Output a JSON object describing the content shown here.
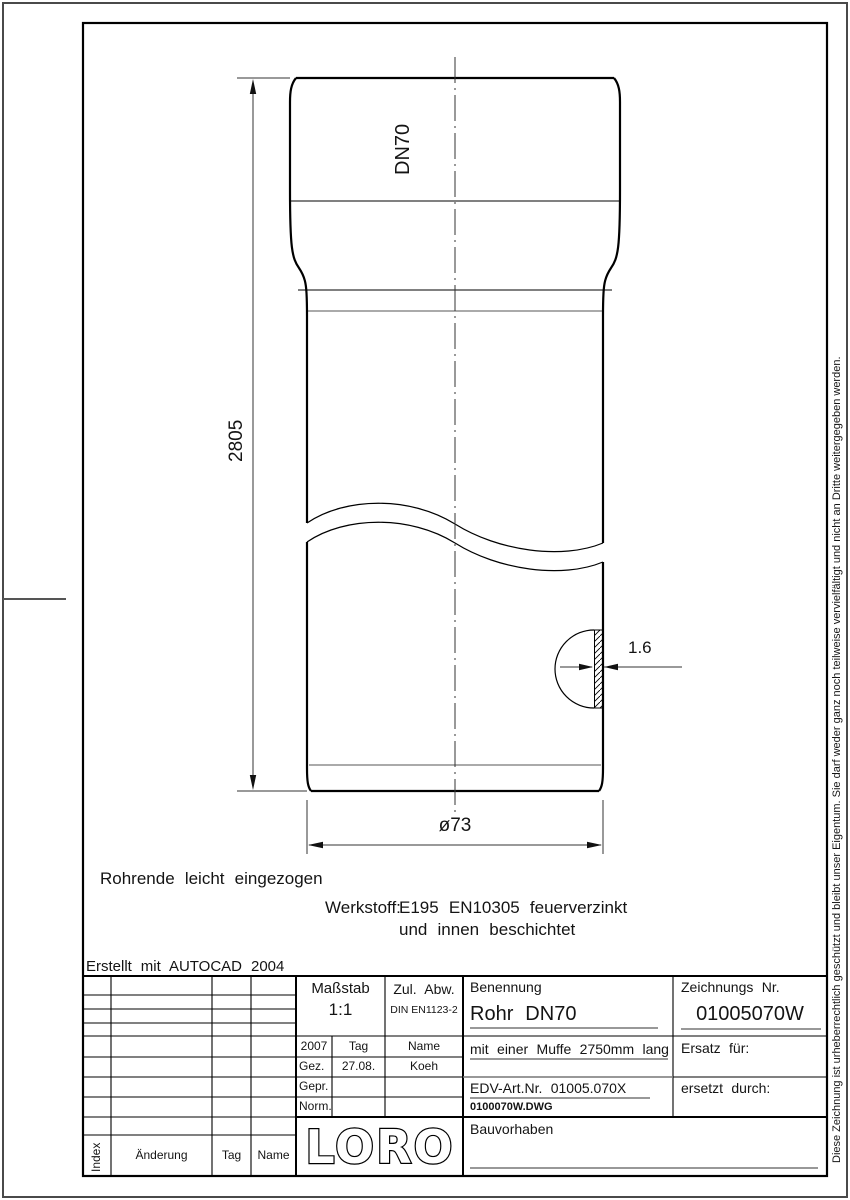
{
  "drawing": {
    "created_with": "Erstellt mit AUTOCAD 2004",
    "pipe_end_note": "Rohrende leicht eingezogen",
    "material_label": "Werkstoff:",
    "material_line1": "E195 EN10305 feuerverzinkt",
    "material_line2": "und innen beschichtet",
    "dim_length": "2805",
    "dim_dn": "DN70",
    "dim_wall_thickness": "1.6",
    "dim_diameter": "ø73"
  },
  "title_block": {
    "masstab": {
      "label": "Maßstab",
      "value": "1:1"
    },
    "zul_abw": {
      "label": "Zul. Abw.",
      "value": "DIN EN1123-2"
    },
    "approval": {
      "year": "2007",
      "tag_header": "Tag",
      "name_header": "Name",
      "rows": [
        {
          "label": "Gez.",
          "tag": "27.08.",
          "name": "Koeh"
        },
        {
          "label": "Gepr.",
          "tag": "",
          "name": ""
        },
        {
          "label": "Norm.",
          "tag": "",
          "name": ""
        }
      ]
    },
    "benennung": {
      "label": "Benennung",
      "value": "Rohr DN70"
    },
    "zeichnungs_nr": {
      "label": "Zeichnungs Nr.",
      "value": "01005070W"
    },
    "description": "mit einer Muffe 2750mm lang",
    "edv_art_nr": "EDV-Art.Nr. 01005.070X",
    "dwg_file": "0100070W.DWG",
    "ersatz_fuer": "Ersatz für:",
    "ersetzt_durch": "ersetzt durch:",
    "bauvorhaben": "Bauvorhaben",
    "logo_text": "LORO",
    "revision_header": {
      "index": "Index",
      "aenderung": "Änderung",
      "tag": "Tag",
      "name": "Name"
    }
  },
  "copyright_note": "Diese Zeichnung ist urheberrechtlich geschützt und bleibt unser Eigentum. Sie darf weder ganz noch teilweise vervielfältigt und nicht an Dritte weitergegeben werden.",
  "colors": {
    "line": "#000000",
    "aux_line": "#555555",
    "background": "#ffffff"
  }
}
